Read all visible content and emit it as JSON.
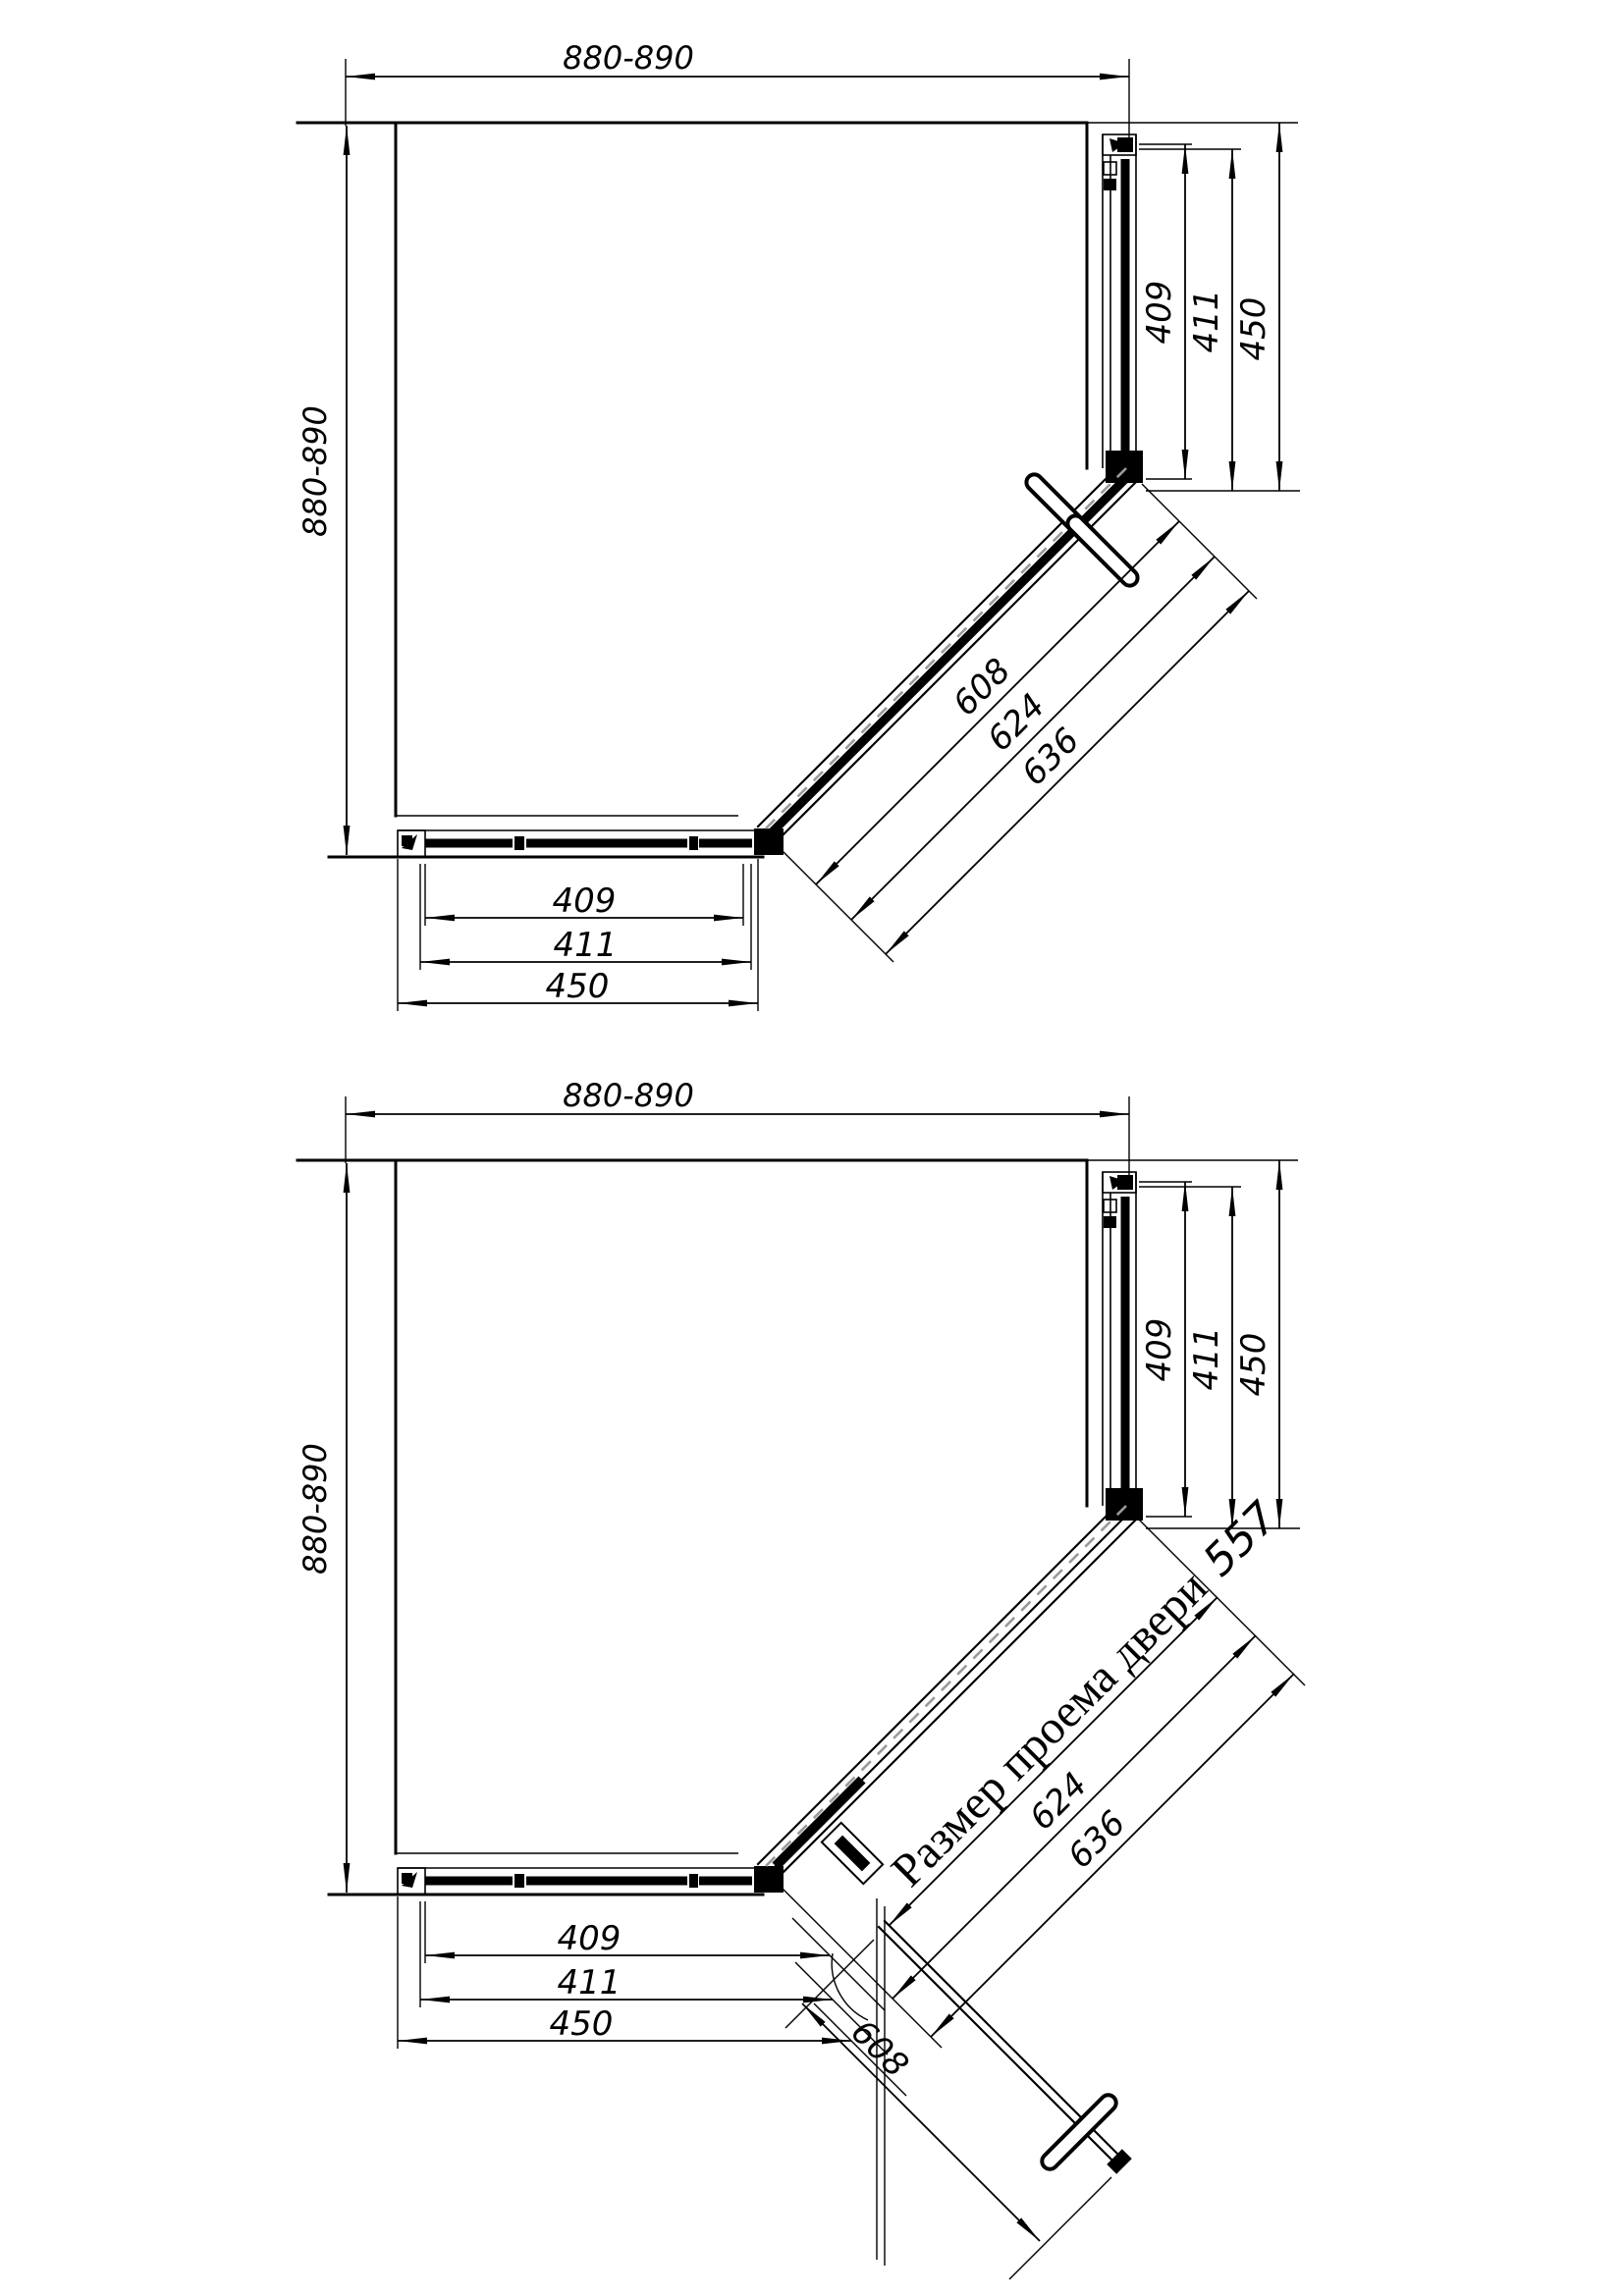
{
  "colors": {
    "ink": "#000000",
    "paper": "#ffffff",
    "roller_dash": "#9a9a9a"
  },
  "view_closed": {
    "dim_width_top": "880-890",
    "dim_height_left": "880-890",
    "side_dims": [
      "409",
      "411",
      "450"
    ],
    "bottom_dims": [
      "409",
      "411",
      "450"
    ],
    "diagonal_dims": [
      "608",
      "624",
      "636"
    ]
  },
  "view_open": {
    "dim_width_top": "880-890",
    "dim_height_left": "880-890",
    "side_dims": [
      "409",
      "411",
      "450"
    ],
    "bottom_dims": [
      "409",
      "411",
      "450"
    ],
    "door_opening_label": "Размер проема двери",
    "door_opening_value": "557",
    "diagonal_dims": [
      "624",
      "636"
    ],
    "door_width": "608"
  }
}
